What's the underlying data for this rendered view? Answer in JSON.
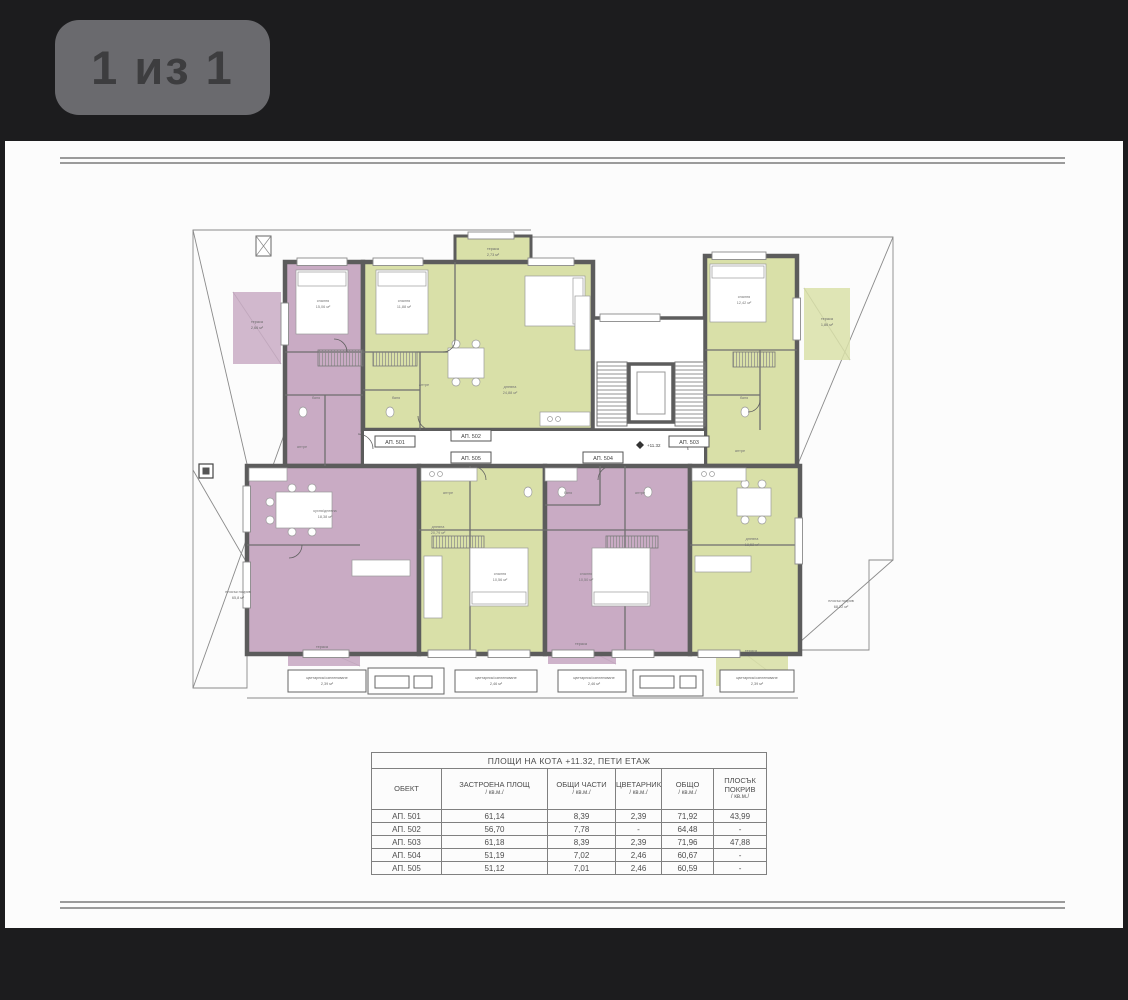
{
  "viewer": {
    "page_badge": "1 из 1"
  },
  "colors": {
    "background": "#1c1c1e",
    "badge_bg": "#6a6a6e",
    "badge_text": "#3d3d3f",
    "page_bg": "#fcfcfc",
    "wall": "#5c5c5c",
    "mauve_apartment": "#c9abc4",
    "green_apartment": "#d9e0a8",
    "thin_line": "#8a8a8a",
    "table_text": "#4d4d4d"
  },
  "plan": {
    "elevation_marker": "+11.32",
    "apartment_labels": [
      {
        "id": "ap-501",
        "text": "АП. 501",
        "x": 395,
        "y": 444
      },
      {
        "id": "ap-502",
        "text": "АП. 502",
        "x": 471,
        "y": 438
      },
      {
        "id": "ap-505",
        "text": "АП. 505",
        "x": 471,
        "y": 460
      },
      {
        "id": "ap-504",
        "text": "АП. 504",
        "x": 603,
        "y": 460
      },
      {
        "id": "ap-503",
        "text": "АП. 503",
        "x": 689,
        "y": 444
      }
    ],
    "area_labels": [
      {
        "text": "тераса",
        "x": 257,
        "y": 323
      },
      {
        "text": "2,66 м²",
        "x": 257,
        "y": 329
      },
      {
        "text": "тераса",
        "x": 493,
        "y": 250
      },
      {
        "text": "2,73 м²",
        "x": 493,
        "y": 256
      },
      {
        "text": "тераса",
        "x": 827,
        "y": 320
      },
      {
        "text": "1,86 м²",
        "x": 827,
        "y": 326
      },
      {
        "text": "плосък покрив",
        "x": 238,
        "y": 593
      },
      {
        "text": "65,8 м²",
        "x": 238,
        "y": 599
      },
      {
        "text": "плосък покрив",
        "x": 841,
        "y": 602
      },
      {
        "text": "68,22 м²",
        "x": 841,
        "y": 608
      },
      {
        "text": "тераса",
        "x": 322,
        "y": 648
      },
      {
        "text": "тераса",
        "x": 581,
        "y": 645
      },
      {
        "text": "тераса",
        "x": 751,
        "y": 652
      },
      {
        "text": "цветарник/озеленяване",
        "x": 327,
        "y": 679
      },
      {
        "text": "2,39 м²",
        "x": 327,
        "y": 685
      },
      {
        "text": "цветарник/озеленяване",
        "x": 496,
        "y": 679
      },
      {
        "text": "2,46 м²",
        "x": 496,
        "y": 685
      },
      {
        "text": "цветарник/озеленяване",
        "x": 594,
        "y": 679
      },
      {
        "text": "2,46 м²",
        "x": 594,
        "y": 685
      },
      {
        "text": "цветарник/озеленяване",
        "x": 757,
        "y": 679
      },
      {
        "text": "2,39 м²",
        "x": 757,
        "y": 685
      }
    ],
    "room_labels": [
      {
        "text": "спалня",
        "x": 323,
        "y": 302
      },
      {
        "text": "15,06 м²",
        "x": 323,
        "y": 308
      },
      {
        "text": "спалня",
        "x": 404,
        "y": 302
      },
      {
        "text": "11,88 м²",
        "x": 404,
        "y": 308
      },
      {
        "text": "дневна",
        "x": 510,
        "y": 388
      },
      {
        "text": "24,88 м²",
        "x": 510,
        "y": 394
      },
      {
        "text": "баня",
        "x": 316,
        "y": 399
      },
      {
        "text": "баня",
        "x": 396,
        "y": 399
      },
      {
        "text": "антре",
        "x": 302,
        "y": 448
      },
      {
        "text": "антре",
        "x": 424,
        "y": 386
      },
      {
        "text": "спалня",
        "x": 744,
        "y": 298
      },
      {
        "text": "12,42 м²",
        "x": 744,
        "y": 304
      },
      {
        "text": "баня",
        "x": 744,
        "y": 399
      },
      {
        "text": "антре",
        "x": 740,
        "y": 452
      },
      {
        "text": "кухня/дневна",
        "x": 325,
        "y": 512
      },
      {
        "text": "18,38 м²",
        "x": 325,
        "y": 518
      },
      {
        "text": "дневна",
        "x": 438,
        "y": 528
      },
      {
        "text": "20,79 м²",
        "x": 438,
        "y": 534
      },
      {
        "text": "спалня",
        "x": 500,
        "y": 575
      },
      {
        "text": "10,56 м²",
        "x": 500,
        "y": 581
      },
      {
        "text": "спалня",
        "x": 586,
        "y": 575
      },
      {
        "text": "10,50 м²",
        "x": 586,
        "y": 581
      },
      {
        "text": "антре",
        "x": 640,
        "y": 494
      },
      {
        "text": "баня",
        "x": 568,
        "y": 494
      },
      {
        "text": "антре",
        "x": 448,
        "y": 494
      },
      {
        "text": "дневна",
        "x": 752,
        "y": 540
      },
      {
        "text": "18,52 м²",
        "x": 752,
        "y": 546
      }
    ]
  },
  "table": {
    "title": "ПЛОЩИ НА КОТА +11.32, ПЕТИ ЕТАЖ",
    "columns": [
      {
        "label": "ОБЕКТ",
        "sub": ""
      },
      {
        "label": "ЗАСТРОЕНА ПЛОЩ",
        "sub": "/ кв.м./"
      },
      {
        "label": "ОБЩИ ЧАСТИ",
        "sub": "/ кв.м./"
      },
      {
        "label": "ЦВЕТАРНИК",
        "sub": "/ кв.м./"
      },
      {
        "label": "ОБЩО",
        "sub": "/ кв.м./"
      },
      {
        "label": "ПЛОСЪК ПОКРИВ",
        "sub": "/ кв.м./"
      }
    ],
    "rows": [
      [
        "АП. 501",
        "61,14",
        "8,39",
        "2,39",
        "71,92",
        "43,99"
      ],
      [
        "АП. 502",
        "56,70",
        "7,78",
        "-",
        "64,48",
        "-"
      ],
      [
        "АП. 503",
        "61,18",
        "8,39",
        "2,39",
        "71,96",
        "47,88"
      ],
      [
        "АП. 504",
        "51,19",
        "7,02",
        "2,46",
        "60,67",
        "-"
      ],
      [
        "АП. 505",
        "51,12",
        "7,01",
        "2,46",
        "60,59",
        "-"
      ]
    ]
  }
}
